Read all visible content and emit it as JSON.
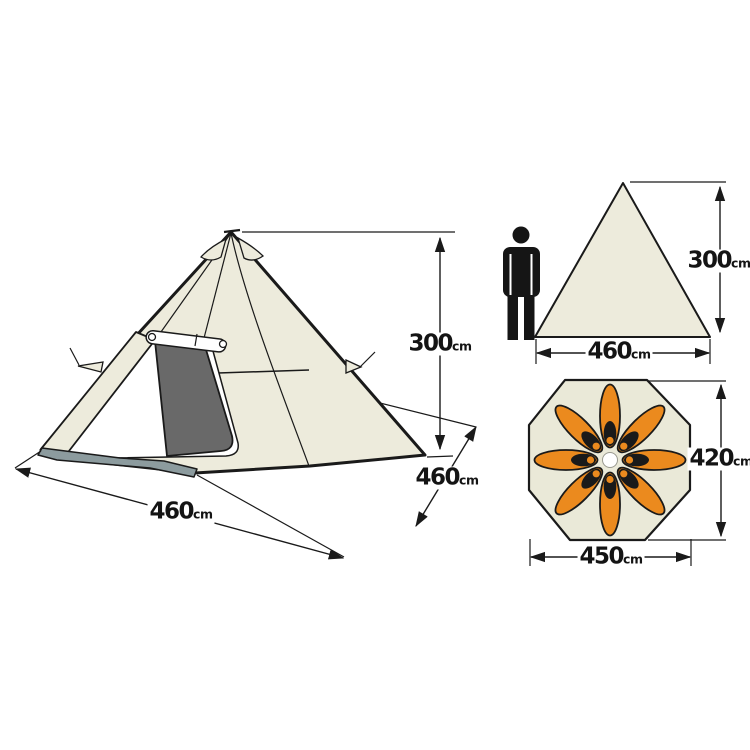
{
  "title": "Teepee tent dimension diagram",
  "views": {
    "perspective": {
      "description": "perspective illustration of teepee tent with mesh door",
      "dimensions": {
        "height": {
          "value": "300",
          "unit": "cm"
        },
        "front_width": {
          "value": "460",
          "unit": "cm"
        },
        "side_depth": {
          "value": "460",
          "unit": "cm"
        }
      }
    },
    "side_elevation": {
      "description": "triangle silhouette with human figure for scale",
      "dimensions": {
        "height": {
          "value": "300",
          "unit": "cm"
        },
        "base_width": {
          "value": "460",
          "unit": "cm"
        }
      }
    },
    "floor_plan": {
      "description": "octagon floor plan with sleeping bags arranged radially",
      "dimensions": {
        "depth": {
          "value": "420",
          "unit": "cm"
        },
        "width": {
          "value": "450",
          "unit": "cm"
        }
      },
      "sleeping_bag_count": 8
    }
  },
  "colors": {
    "fabric": "#EDEBDC",
    "floor_fabric": "#EAE9D8",
    "mesh_door": "#696969",
    "ground_sill": "#8C9B9E",
    "sleeping_bag": "#EB8A1E",
    "figure": "#151515",
    "line": "#1A1A1A",
    "background": "#FFFFFF"
  }
}
